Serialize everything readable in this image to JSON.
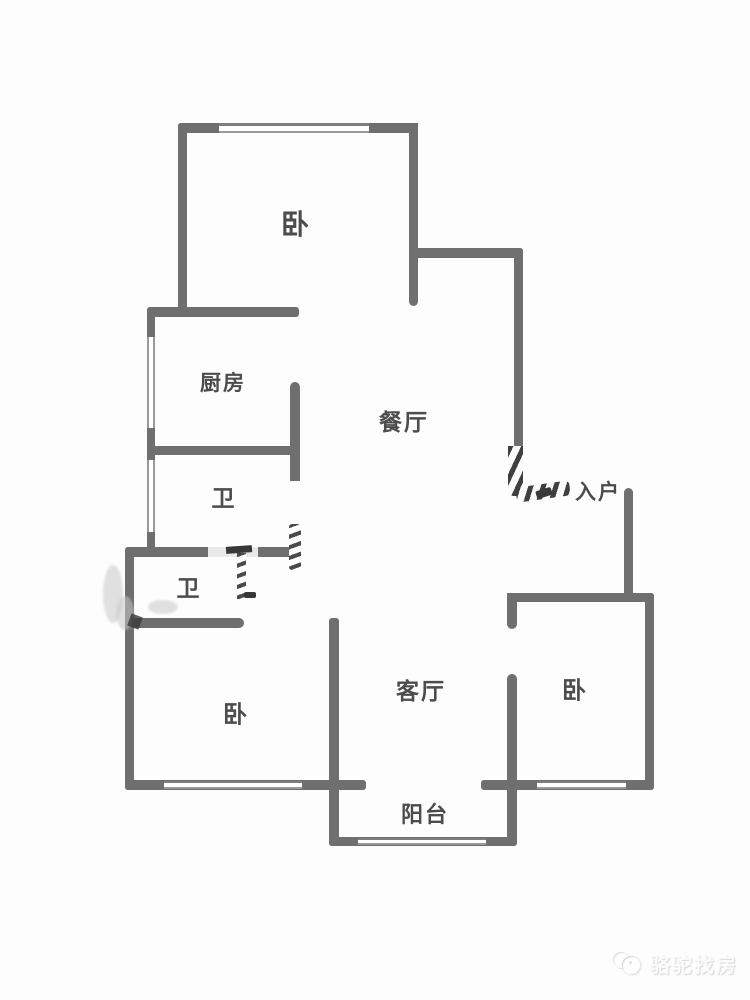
{
  "floorplan": {
    "type": "apartment-floor-plan",
    "rooms": [
      {
        "name": "bedroom-top",
        "label": "卧"
      },
      {
        "name": "kitchen",
        "label": "厨房"
      },
      {
        "name": "dining-room",
        "label": "餐厅"
      },
      {
        "name": "bathroom-upper",
        "label": "卫"
      },
      {
        "name": "entry",
        "label": "入户"
      },
      {
        "name": "bathroom-lower",
        "label": "卫"
      },
      {
        "name": "bedroom-left",
        "label": "卧"
      },
      {
        "name": "living-room",
        "label": "客厅"
      },
      {
        "name": "bedroom-right",
        "label": "卧"
      },
      {
        "name": "balcony",
        "label": "阳台"
      }
    ],
    "colors": {
      "wall": "#6f6f6f",
      "label": "#4c4c4c",
      "background": "#fdfdfd",
      "watermark": "#fbfbfb"
    }
  },
  "watermark": {
    "brand": "骆驼找房",
    "logo_icon": "camel-logo"
  }
}
